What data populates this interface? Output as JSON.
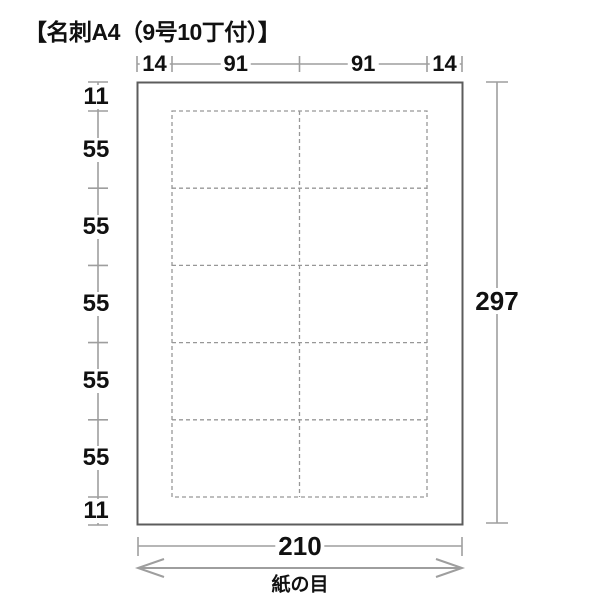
{
  "title": "【名刺A4（9号10丁付）】",
  "diagram": {
    "top_dimensions": [
      "14",
      "91",
      "91",
      "14"
    ],
    "left_dimensions": [
      "11",
      "55",
      "55",
      "55",
      "55",
      "55",
      "11"
    ],
    "right_dimension": "297",
    "bottom_dimension": "210",
    "grain_label": "紙の目",
    "sheet": {
      "width_mm": 210,
      "height_mm": 297
    },
    "card_grid": {
      "columns": 2,
      "rows": 5,
      "card_width_mm": 91,
      "card_height_mm": 55
    }
  },
  "colors": {
    "background": "#ffffff",
    "paper_border": "#5c5c5c",
    "dimension_line": "#9e9e9e",
    "dashed_line": "#979797",
    "text": "#111111"
  }
}
